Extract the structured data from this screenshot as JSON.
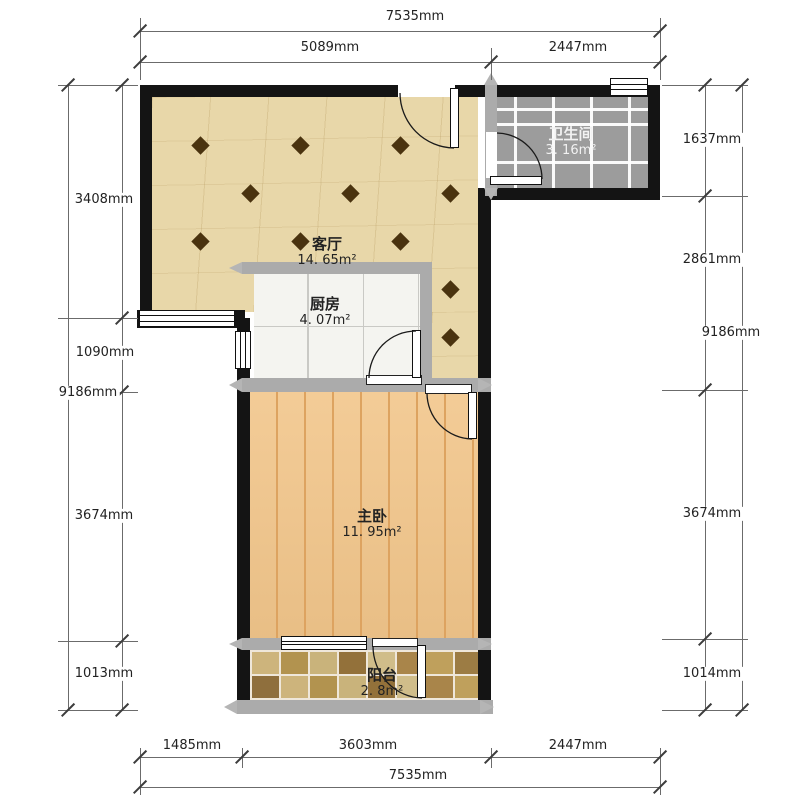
{
  "plan_title": "floor-plan",
  "rooms": [
    {
      "name": "客厅",
      "area": "14. 65m²"
    },
    {
      "name": "厨房",
      "area": "4. 07m²"
    },
    {
      "name": "卫生间",
      "area": "3. 16m²"
    },
    {
      "name": "主卧",
      "area": "11. 95m²"
    },
    {
      "name": "阳台",
      "area": "2. 8m²"
    }
  ],
  "dimensions": {
    "top": {
      "total": "7535mm",
      "segments": [
        "5089mm",
        "2447mm"
      ]
    },
    "bottom": {
      "total": "7535mm",
      "segments": [
        "1485mm",
        "3603mm",
        "2447mm"
      ]
    },
    "left": {
      "total": "9186mm",
      "segments": [
        "3408mm",
        "1090mm",
        "3674mm",
        "1013mm"
      ]
    },
    "right": {
      "total": "9186mm",
      "segments": [
        "1637mm",
        "2861mm",
        "3674mm",
        "1014mm"
      ]
    }
  },
  "colors": {
    "wall_black": "#141414",
    "wall_gray": "#ababab",
    "living_floor": "#e8d7a9",
    "living_diamond": "#4a330f",
    "kitchen_tile": "#f4f4f0",
    "bathroom_tile": "#9c9c9c",
    "bedroom_floor": "#f2c68b",
    "balcony_grout": "#efe7da",
    "dimension_text": "#222222"
  }
}
